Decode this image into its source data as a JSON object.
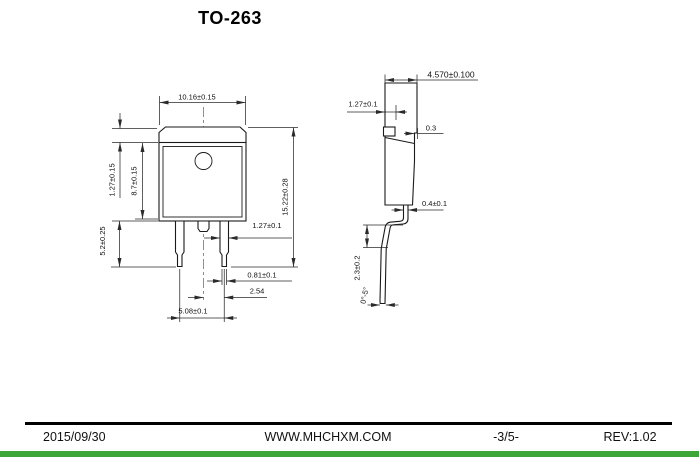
{
  "page": {
    "title": "TO-263"
  },
  "front_view": {
    "body_width": "10.16±0.15",
    "tab_height": "1.27±0.15",
    "body_height": "8.7±0.15",
    "lead_length": "5.2±0.25",
    "overall_height": "15.22±0.28",
    "lead_width": "1.27±0.1",
    "lead_tip_width": "0.81±0.1",
    "lead_pitch": "2.54",
    "lead_span": "5.08±0.1"
  },
  "side_view": {
    "overall_depth": "4.570±0.100",
    "tab_thickness": "1.27±0.1",
    "step_depth": "0.3",
    "lead_thickness": "0.4±0.1",
    "foot_height": "2.3±0.2",
    "foot_angle": "0°-5°"
  },
  "footer": {
    "date": "2015/09/30",
    "website": "WWW.MHCHXM.COM",
    "page_number": "-3/5-",
    "revision": "REV:1.02"
  },
  "colors": {
    "accent_green": "#3DA639",
    "drawing_line": "#1a1a1a"
  }
}
